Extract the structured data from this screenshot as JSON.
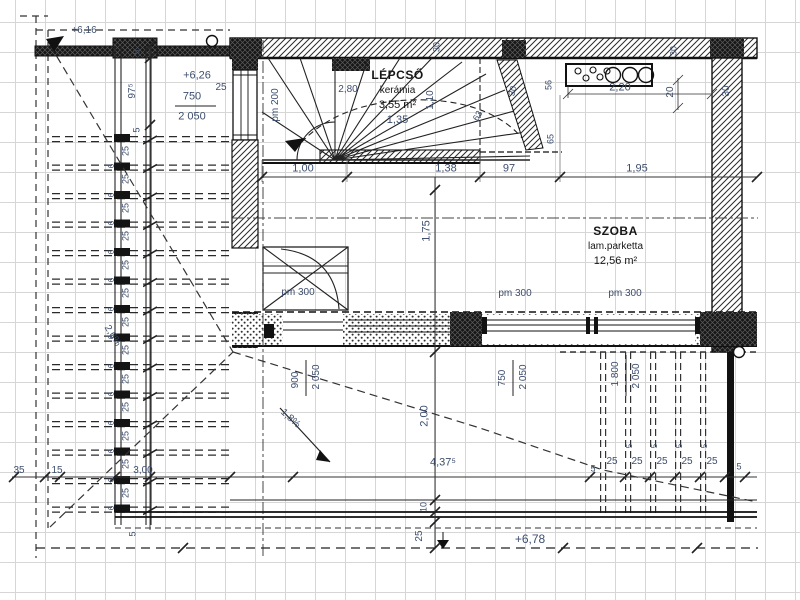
{
  "drawing": {
    "kind": "architectural floor plan (Hungarian)",
    "rooms": [
      {
        "name": "LÉPCSŐ",
        "finish": "kerámia",
        "area": "3,55 m²",
        "extra": "1,35"
      },
      {
        "name": "SZOBA",
        "finish": "lam.parketta",
        "area": "12,56 m²"
      }
    ]
  },
  "annotations": [
    {
      "t": "+6,16",
      "x": 84,
      "y": 31,
      "s": 10,
      "n": "level-label"
    },
    {
      "t": "+6,26",
      "x": 197,
      "y": 76,
      "s": 11,
      "n": "level-label"
    },
    {
      "t": "750",
      "x": 192,
      "y": 97,
      "s": 11,
      "n": "opening-size-label"
    },
    {
      "t": "2 050",
      "x": 192,
      "y": 117,
      "s": 11,
      "n": "opening-size-label"
    },
    {
      "t": "25",
      "x": 221,
      "y": 88,
      "s": 10
    },
    {
      "t": "5",
      "x": 137,
      "y": 52,
      "r": -90,
      "s": 9
    },
    {
      "t": "97⁵",
      "x": 133,
      "y": 91,
      "r": -90,
      "s": 10
    },
    {
      "t": "5",
      "x": 137,
      "y": 130,
      "r": -90,
      "s": 9
    },
    {
      "t": "25",
      "x": 126,
      "y": 151,
      "r": -90,
      "s": 9
    },
    {
      "t": "25",
      "x": 126,
      "y": 179,
      "r": -90,
      "s": 9
    },
    {
      "t": "25",
      "x": 126,
      "y": 208,
      "r": -90,
      "s": 9
    },
    {
      "t": "25",
      "x": 126,
      "y": 236,
      "r": -90,
      "s": 9
    },
    {
      "t": "25",
      "x": 126,
      "y": 265,
      "r": -90,
      "s": 9
    },
    {
      "t": "25",
      "x": 126,
      "y": 293,
      "r": -90,
      "s": 9
    },
    {
      "t": "25",
      "x": 126,
      "y": 322,
      "r": -90,
      "s": 9
    },
    {
      "t": "25",
      "x": 126,
      "y": 350,
      "r": -90,
      "s": 9
    },
    {
      "t": "25",
      "x": 126,
      "y": 379,
      "r": -90,
      "s": 9
    },
    {
      "t": "25",
      "x": 126,
      "y": 407,
      "r": -90,
      "s": 9
    },
    {
      "t": "25",
      "x": 126,
      "y": 436,
      "r": -90,
      "s": 9
    },
    {
      "t": "25",
      "x": 126,
      "y": 464,
      "r": -90,
      "s": 9
    },
    {
      "t": "25",
      "x": 126,
      "y": 493,
      "r": -90,
      "s": 9
    },
    {
      "t": "6",
      "x": 112,
      "y": 166,
      "r": -90,
      "s": 8
    },
    {
      "t": "6",
      "x": 112,
      "y": 195,
      "r": -90,
      "s": 8
    },
    {
      "t": "6",
      "x": 112,
      "y": 223,
      "r": -90,
      "s": 8
    },
    {
      "t": "6",
      "x": 112,
      "y": 252,
      "r": -90,
      "s": 8
    },
    {
      "t": "6",
      "x": 112,
      "y": 280,
      "r": -90,
      "s": 8
    },
    {
      "t": "6",
      "x": 112,
      "y": 309,
      "r": -90,
      "s": 8
    },
    {
      "t": "6",
      "x": 112,
      "y": 337,
      "r": -90,
      "s": 8
    },
    {
      "t": "6",
      "x": 112,
      "y": 366,
      "r": -90,
      "s": 8
    },
    {
      "t": "6",
      "x": 112,
      "y": 394,
      "r": -90,
      "s": 8
    },
    {
      "t": "6",
      "x": 112,
      "y": 423,
      "r": -90,
      "s": 8
    },
    {
      "t": "6",
      "x": 112,
      "y": 451,
      "r": -90,
      "s": 8
    },
    {
      "t": "6",
      "x": 112,
      "y": 480,
      "r": -90,
      "s": 8
    },
    {
      "t": "6",
      "x": 112,
      "y": 508,
      "r": -90,
      "s": 8
    },
    {
      "t": "5",
      "x": 133,
      "y": 534,
      "r": -90,
      "s": 9
    },
    {
      "t": "35",
      "x": 19,
      "y": 471,
      "s": 10
    },
    {
      "t": "15",
      "x": 57,
      "y": 471,
      "s": 10
    },
    {
      "t": "3,00",
      "x": 143,
      "y": 471,
      "s": 10
    },
    {
      "t": "2,80",
      "x": 348,
      "y": 90,
      "s": 10
    },
    {
      "t": "pm 200",
      "x": 276,
      "y": 105,
      "r": -90,
      "s": 10,
      "n": "parapet-height-label"
    },
    {
      "t": "1,10",
      "x": 431,
      "y": 100,
      "r": -90,
      "s": 10
    },
    {
      "t": "30",
      "x": 437,
      "y": 47,
      "r": -90,
      "s": 9
    },
    {
      "t": "30",
      "x": 513,
      "y": 91,
      "r": -75,
      "s": 9
    },
    {
      "t": "63",
      "x": 478,
      "y": 116,
      "r": -60,
      "s": 9
    },
    {
      "t": "56",
      "x": 549,
      "y": 85,
      "r": -90,
      "s": 9
    },
    {
      "t": "65",
      "x": 551,
      "y": 139,
      "r": -90,
      "s": 9
    },
    {
      "t": "2,20",
      "x": 620,
      "y": 88,
      "s": 11
    },
    {
      "t": "20",
      "x": 671,
      "y": 92,
      "r": -90,
      "s": 10
    },
    {
      "t": "30",
      "x": 674,
      "y": 51,
      "r": -90,
      "s": 9
    },
    {
      "t": "30",
      "x": 727,
      "y": 91,
      "r": -90,
      "s": 10
    },
    {
      "t": "1,00",
      "x": 303,
      "y": 169,
      "s": 11
    },
    {
      "t": "1,38",
      "x": 446,
      "y": 169,
      "s": 11
    },
    {
      "t": "97",
      "x": 509,
      "y": 169,
      "s": 11
    },
    {
      "t": "1,95",
      "x": 637,
      "y": 169,
      "s": 11
    },
    {
      "t": "1,75",
      "x": 427,
      "y": 231,
      "r": -90,
      "s": 11
    },
    {
      "t": "2,00",
      "x": 425,
      "y": 416,
      "r": -90,
      "s": 11
    },
    {
      "t": "10",
      "x": 424,
      "y": 507,
      "r": -90,
      "s": 9
    },
    {
      "t": "25",
      "x": 420,
      "y": 536,
      "r": -90,
      "s": 10
    },
    {
      "t": "pm 300",
      "x": 298,
      "y": 293,
      "s": 10,
      "n": "parapet-height-label"
    },
    {
      "t": "pm 300",
      "x": 515,
      "y": 294,
      "s": 10,
      "n": "parapet-height-label"
    },
    {
      "t": "pm 300",
      "x": 625,
      "y": 294,
      "s": 10,
      "n": "parapet-height-label"
    },
    {
      "t": "900",
      "x": 296,
      "y": 380,
      "r": -90,
      "s": 10,
      "n": "opening-size-label"
    },
    {
      "t": "2 050",
      "x": 317,
      "y": 377,
      "r": -90,
      "s": 10,
      "n": "opening-size-label"
    },
    {
      "t": "750",
      "x": 503,
      "y": 378,
      "r": -90,
      "s": 10,
      "n": "opening-size-label"
    },
    {
      "t": "2 050",
      "x": 524,
      "y": 377,
      "r": -90,
      "s": 10,
      "n": "opening-size-label"
    },
    {
      "t": "1 800",
      "x": 616,
      "y": 374,
      "r": -90,
      "s": 10,
      "n": "opening-size-label"
    },
    {
      "t": "2 050",
      "x": 637,
      "y": 376,
      "r": -90,
      "s": 10,
      "n": "opening-size-label"
    },
    {
      "t": "1,8%",
      "x": 290,
      "y": 419,
      "r": 42,
      "s": 10,
      "n": "slope-label"
    },
    {
      "t": "2,6%",
      "x": 112,
      "y": 336,
      "r": 58,
      "s": 10,
      "n": "slope-label"
    },
    {
      "t": "4,37⁵",
      "x": 443,
      "y": 463,
      "s": 11
    },
    {
      "t": "+6,78",
      "x": 530,
      "y": 539,
      "s": 12,
      "n": "level-label"
    },
    {
      "t": "5",
      "x": 593,
      "y": 469,
      "s": 9
    },
    {
      "t": "25",
      "x": 612,
      "y": 462,
      "s": 10
    },
    {
      "t": "25",
      "x": 637,
      "y": 462,
      "s": 10
    },
    {
      "t": "25",
      "x": 662,
      "y": 462,
      "s": 10
    },
    {
      "t": "25",
      "x": 687,
      "y": 462,
      "s": 10
    },
    {
      "t": "25",
      "x": 712,
      "y": 462,
      "s": 10
    },
    {
      "t": "5",
      "x": 739,
      "y": 467,
      "s": 9
    },
    {
      "t": "5",
      "x": 630,
      "y": 446,
      "r": -90,
      "s": 8
    },
    {
      "t": "5",
      "x": 655,
      "y": 446,
      "r": -90,
      "s": 8
    },
    {
      "t": "5",
      "x": 680,
      "y": 446,
      "r": -90,
      "s": 8
    },
    {
      "t": "5",
      "x": 705,
      "y": 446,
      "r": -90,
      "s": 8
    }
  ]
}
